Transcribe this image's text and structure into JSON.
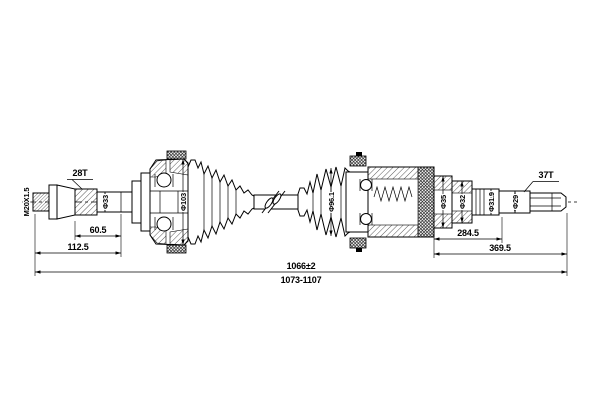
{
  "drawing": {
    "thread_label": "M20X1.5",
    "left_spline": "28T",
    "right_spline": "37T",
    "diameters": {
      "shaft": "Φ33",
      "outer_joint": "Φ103",
      "inner_boot": "Φ96.1",
      "spline_seat": "Φ35",
      "bearing_seat": "Φ32",
      "ring_groove": "Φ31.9",
      "shaft_end": "Φ29"
    },
    "dimensions": {
      "left_spline_length": "60.5",
      "left_stub_length": "112.5",
      "right_shaft_length": "284.5",
      "right_stub_length": "369.5",
      "overall_length": "1066±2",
      "length_range": "1073-1107"
    }
  }
}
